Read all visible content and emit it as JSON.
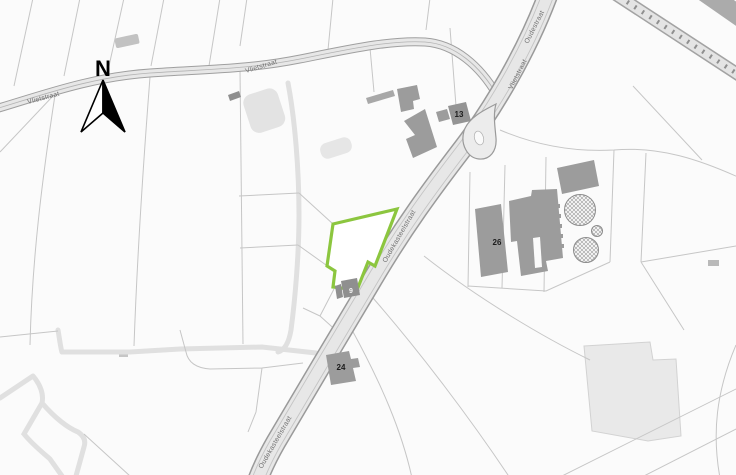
{
  "map": {
    "compass_label": "N",
    "streets": {
      "vlietstraat_west": "Vlietstraat",
      "vlietstraat_mid": "Vlietstraat",
      "vlietstraat_north": "Vlietstraat",
      "oudestraat": "Oudestraat",
      "oudekasteelstraat_mid": "Oudekasteelstraat",
      "oudekasteelstraat_south": "Oudekasteelstraat"
    },
    "house_numbers": {
      "num_13": "13",
      "num_26": "26",
      "num_24": "24",
      "num_9": "9"
    },
    "colors": {
      "highlight_parcel_stroke": "#8cc63f",
      "road_fill": "#e7e7e7",
      "road_edge": "#9f9f9f",
      "building_fill": "#9c9c9c",
      "building_dark_fill": "#8f8f8f",
      "background": "#fbfbfb",
      "parcel_line": "#c6c6c6"
    },
    "icons": {
      "north_arrow": "north-arrow"
    }
  }
}
